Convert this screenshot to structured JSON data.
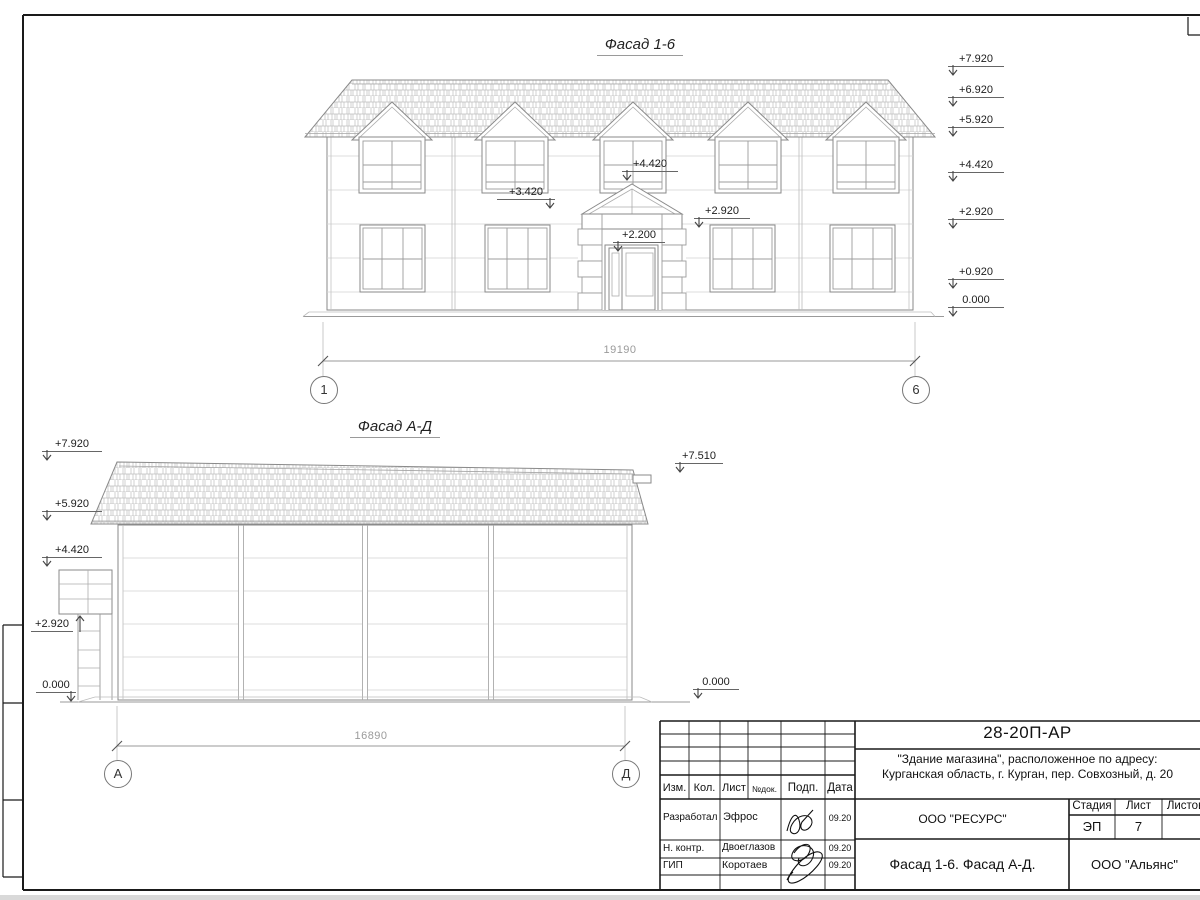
{
  "drawing1": {
    "title": "Фасад 1-6",
    "dimension": "19190",
    "axis_start": "1",
    "axis_end": "6",
    "right_marks": [
      "+7.920",
      "+6.920",
      "+5.920",
      "+4.420",
      "+2.920",
      "+0.920",
      "0.000"
    ],
    "facade_marks": [
      "+4.420",
      "+3.420",
      "+2.920",
      "+2.200"
    ]
  },
  "drawing2": {
    "title": "Фасад А-Д",
    "dimension": "16890",
    "axis_start": "А",
    "axis_end": "Д",
    "left_marks": [
      "+7.920",
      "+5.920",
      "+4.420",
      "+2.920",
      "0.000"
    ],
    "right_marks": [
      "+7.510",
      "0.000"
    ]
  },
  "title_block": {
    "doc_number": "28-20П-АР",
    "project_line1": "\"Здание магазина\", расположенное по адресу:",
    "project_line2": "Курганская область, г. Курган, пер. Совхозный, д. 20",
    "table_headers": [
      "Изм.",
      "Кол.",
      "Лист",
      "№док.",
      "Подп.",
      "Дата"
    ],
    "staff_rows": [
      {
        "role": "Разработал",
        "name": "Эфрос",
        "date": "09.20"
      },
      {
        "role": "Н. контр.",
        "name": "Двоеглазов",
        "date": "09.20"
      },
      {
        "role": "ГИП",
        "name": "Коротаев",
        "date": "09.20"
      }
    ],
    "designer_org": "ООО \"РЕСУРС\"",
    "stage_header": "Стадия",
    "sheet_header": "Лист",
    "sheets_header": "Листов",
    "stage": "ЭП",
    "sheet_number": "7",
    "sheet_title": "Фасад 1-6. Фасад А-Д.",
    "org": "ООО \"Альянс\""
  }
}
